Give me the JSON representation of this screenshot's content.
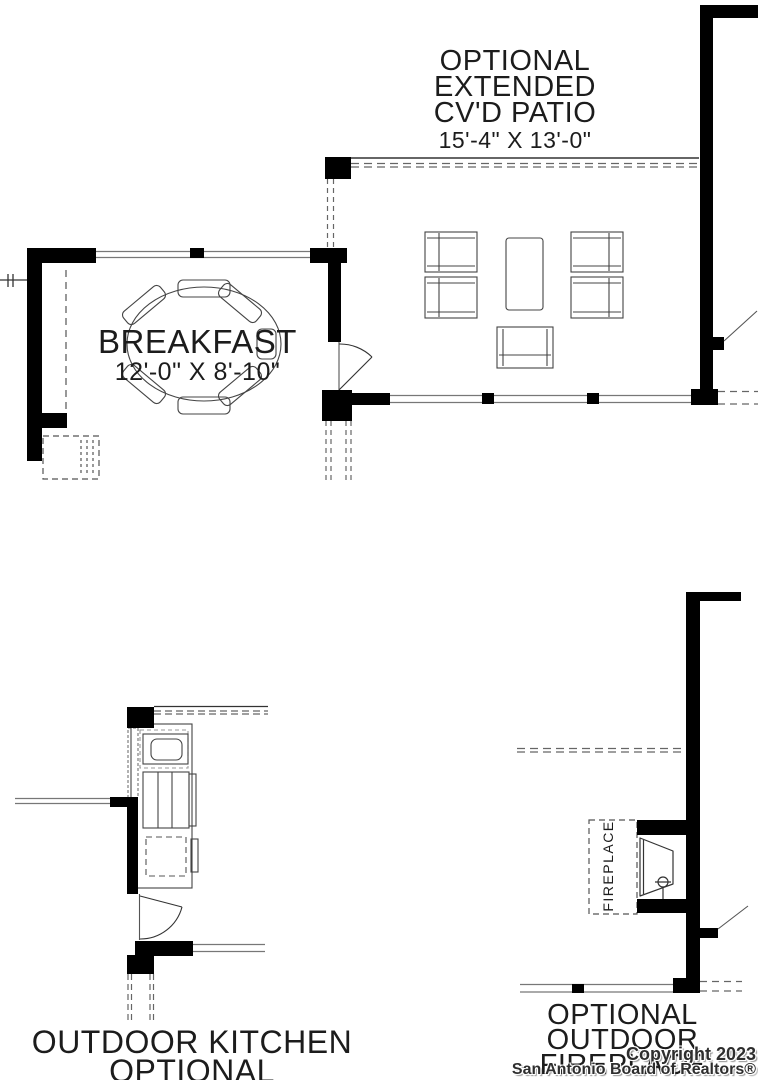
{
  "labels": {
    "patio": {
      "line1": "OPTIONAL",
      "line2": "EXTENDED",
      "line3": "CV'D PATIO",
      "dims": "15'-4\" X 13'-0\""
    },
    "breakfast": {
      "name": "BREAKFAST",
      "dims": "12'-0\" X 8'-10\""
    },
    "outdoor_kitchen": {
      "line1": "OUTDOOR KITCHEN",
      "line2": "OPTIONAL"
    },
    "outdoor_fireplace": {
      "line1": "OPTIONAL",
      "line2": "OUTDOOR",
      "line3": "FIREPLACE"
    },
    "fireplace_fixture": "FIREPLACE"
  },
  "watermark": {
    "line1": "Copyright 2023",
    "line2": "San Antonio Board of Realtors®"
  },
  "colors": {
    "ink": "#000000",
    "thin_line": "#777777",
    "dash_line": "#666666",
    "paper": "#ffffff",
    "watermark_text": "#2e2e2e"
  }
}
